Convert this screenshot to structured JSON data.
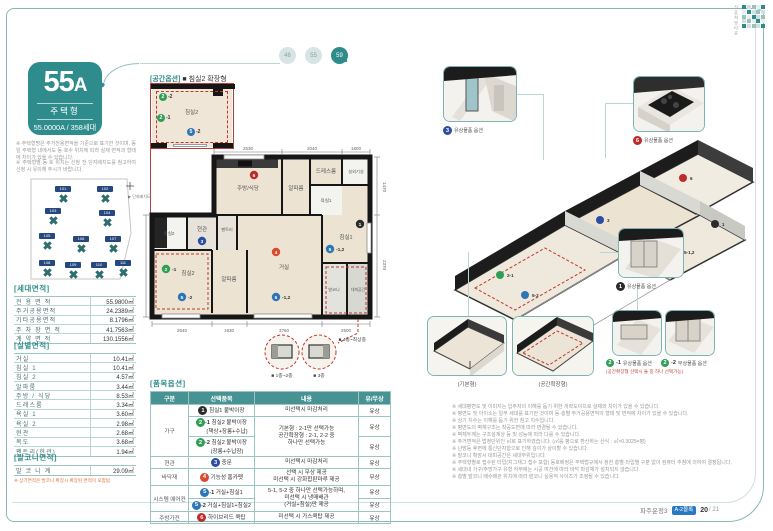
{
  "brand": {
    "logo_text": "신혼희망타운",
    "footer_project": "파주운정3",
    "footer_badge": "A-2블록",
    "footer_page": "20",
    "footer_total": "/ 21"
  },
  "nav": {
    "circles": [
      {
        "label": "46"
      },
      {
        "label": "55"
      },
      {
        "label": "59"
      }
    ]
  },
  "unit": {
    "type_num": "55",
    "type_sfx": "A",
    "category": "주택형",
    "summary": "55.0000A / 358세대",
    "notes": [
      "※ 주택형명은 주거전용면적을 기준으로 표기한 것이며, 동일 주택형 내에서도 동·호수 위치에 따라 실제 면적과 형태에 차이가 있을 수 있습니다.",
      "※ 주택형별 동·호 위치는 신청 전 단지배치도를 참고하여 신청 시 유의해 주시기 바랍니다."
    ]
  },
  "site_plan": {
    "caption": "▶ 단지배치도",
    "buildings": [
      "101",
      "102",
      "103",
      "104",
      "105",
      "106",
      "107",
      "108",
      "109",
      "110",
      "111"
    ]
  },
  "household_area": {
    "title": "[세대면적]",
    "rows": [
      {
        "label": "전 용 면 적",
        "value": "55.9800㎡"
      },
      {
        "label": "주거공용면적",
        "value": "24.2389㎡"
      },
      {
        "label": "기타공용면적",
        "value": "8.1796㎡"
      },
      {
        "label": "주 차 장 면 적",
        "value": "41.7563㎡"
      },
      {
        "label": "계 약 면 적",
        "value": "130.1556㎡"
      }
    ]
  },
  "room_area": {
    "title": "[실별면적]",
    "rows": [
      {
        "label": "거실",
        "value": "10.41㎡"
      },
      {
        "label": "침실 1",
        "value": "10.41㎡"
      },
      {
        "label": "침실 2",
        "value": "4.57㎡"
      },
      {
        "label": "알파룸",
        "value": "3.44㎡"
      },
      {
        "label": "주방 / 식당",
        "value": "8.53㎡"
      },
      {
        "label": "드레스룸",
        "value": "3.34㎡"
      },
      {
        "label": "욕실 1",
        "value": "3.60㎡"
      },
      {
        "label": "욕실 2",
        "value": "2.98㎡"
      },
      {
        "label": "현관",
        "value": "2.68㎡"
      },
      {
        "label": "복도",
        "value": "3.68㎡"
      },
      {
        "label": "팬트리(현관)",
        "value": "1.94㎡"
      }
    ]
  },
  "balcony_area": {
    "title": "[발코니면적]",
    "rows": [
      {
        "label": "발 코 니 계",
        "value": "29.09㎡"
      }
    ],
    "note": "※ 상기면적은 발코니 확장시 확장된 면적이 포함됨"
  },
  "plan": {
    "inset_tag": "[공간옵션]",
    "inset_name": "■ 침실2 확장형",
    "inset_room": "침실2",
    "rooms": {
      "kitchen": "주방/식당",
      "alpha": "알파룸",
      "dress": "드레스룸",
      "util": "실외기실",
      "bath1": "욕실1",
      "bath2": "욕실2",
      "entry": "현관",
      "pantry": "팬트리",
      "bed1": "침실1",
      "bed2": "침실2",
      "living": "거실",
      "balcony": "발코니",
      "shelter": "대피공간"
    },
    "markers": {
      "n1": "1",
      "n2": "2",
      "n3": "3",
      "n4": "4",
      "n5": "5",
      "n6": "6",
      "s1": "-1",
      "s2": "-2",
      "s12": "-1,2"
    },
    "dims_top": [
      "2530",
      "2040",
      "1800"
    ],
    "dims_bottom": [
      "2640",
      "1930",
      "3760",
      "2500"
    ],
    "dims_right": [
      "1470",
      "2370"
    ],
    "dims_left": [
      "2130"
    ],
    "details": {
      "d1": "■ 1층~2층",
      "d2": "■ 3층",
      "d3": "■ 4층~최상층"
    }
  },
  "options": {
    "title": "[품목옵션]",
    "headers": [
      "구분",
      "선택품목",
      "내용",
      "유/무상"
    ],
    "groups": {
      "g1": "가구",
      "g2": "현관",
      "g3": "바닥재",
      "g4": "시스템 에어컨",
      "g5": "주방가전"
    },
    "rows": [
      {
        "num": "1",
        "sfx": "",
        "item": "침실1 붙박이장",
        "item2": "",
        "desc": [
          "미선택시 마감처리"
        ],
        "price": "유상"
      },
      {
        "num": "2",
        "sfx": "-1",
        "item": "침실2 붙박이장",
        "item2": "(책상+장롱+수납)",
        "desc": [
          "기본형 : 2-1만 선택가능",
          "공간확장형 : 2-1, 2-2 중",
          "하나만 선택가능"
        ],
        "price": "유상"
      },
      {
        "num": "2",
        "sfx": "-2",
        "item": "침실2 붙박이장",
        "item2": "(장롱+수납장)",
        "desc": [],
        "price": "유상"
      },
      {
        "num": "3",
        "sfx": "",
        "item": "중문",
        "item2": "",
        "desc": [
          "미선택시 마감처리"
        ],
        "price": "유상"
      },
      {
        "num": "4",
        "sfx": "",
        "item": "기능성 홈카펫",
        "item2": "",
        "desc": [
          "선택 시 무상 제공",
          "미선택 시 강화합판마루 제공"
        ],
        "price": "무상"
      },
      {
        "num": "5",
        "sfx": "-1",
        "item": "거실+침실1",
        "item2": "",
        "desc": [
          "5-1, 5-2 중 하나만 선택가능하며,",
          "미선택 시 냉매배관",
          "(거실+침실)만 제공"
        ],
        "price": "유상"
      },
      {
        "num": "5",
        "sfx": "-2",
        "item": "거실+침실1+침실2",
        "item2": "",
        "desc": [],
        "price": "유상"
      },
      {
        "num": "6",
        "sfx": "",
        "item": "하이브리드 쿡탑",
        "item2": "",
        "desc": [
          "미선택 시 가스쿡탑 제공"
        ],
        "price": "유상"
      }
    ]
  },
  "axon": {
    "callouts": {
      "door": {
        "num": "3",
        "sfx": "",
        "text": "유상물품 옵션"
      },
      "cooktop": {
        "num": "6",
        "sfx": "",
        "text": "유상물품 옵션"
      },
      "wardrobe1": {
        "num": "1",
        "sfx": "",
        "text": "유상물품 옵션"
      },
      "basic": {
        "text": "(기본형)"
      },
      "expanded": {
        "text": "(공간확장형)"
      },
      "w2_1": {
        "num": "2",
        "sfx": "-1",
        "text": "유상물품 옵션"
      },
      "w2_2": {
        "num": "2",
        "sfx": "-2",
        "text": "무상물품 옵션"
      },
      "note": "(공간확장형 선택시 둘 중 하나 선택가능)"
    },
    "markers": [
      {
        "t": "2-1"
      },
      {
        "t": "3"
      },
      {
        "t": "6"
      },
      {
        "t": "5-1,2"
      },
      {
        "t": "1"
      },
      {
        "t": "5-2"
      }
    ]
  },
  "disclaimers": [
    "※ 세대평면도 및 이미지는 입주자의 이해를 돕기 위한 개략도이므로 실제와 차이가 있을 수 있습니다.",
    "※ 평면도 및 아이소는 일부 세대를 표기한 것이며 동·층별 주거공용면적의 형태 및 면적에 차이가 있을 수 있습니다.",
    "※ 상기 치수는 이해를 돕기 위한 참고 치수입니다.",
    "※ 평면도의 벽체구조는 착공도면에 따라 변경될 수 있습니다.",
    "※ 벽체두께는 구조설계상 등 및 성능에 따라 다를 수 있습니다.",
    "※ 주거면적은 법정단위인 ㎡로 표기하였습니다. (㎡를 평으로 환산하는 산식 : ㎡×0.3025=평)",
    "※ 난방등 후면에 통신단자함으로 인해 깊이가 상이할 수 있습니다.",
    "※ 발코니 확장시 대피공간은 세대부위입니다.",
    "※ 주택형별로 접수된 타입(지그재그 접수 포함) 동호배정은 주택법규에서 정한 층별·타입별 구분 없이 컴퓨터 추첨에 의하여 결정됩니다.",
    "※ 세대내 가구/주방가구 유형 하부에는 시공 여건에 따라 바닥 마감재가 설치되지 않습니다.",
    "※ 층별 발코니 배수배관 위치에 따라 발코니 실용적 사이즈가 조정될 수 있습니다."
  ]
}
